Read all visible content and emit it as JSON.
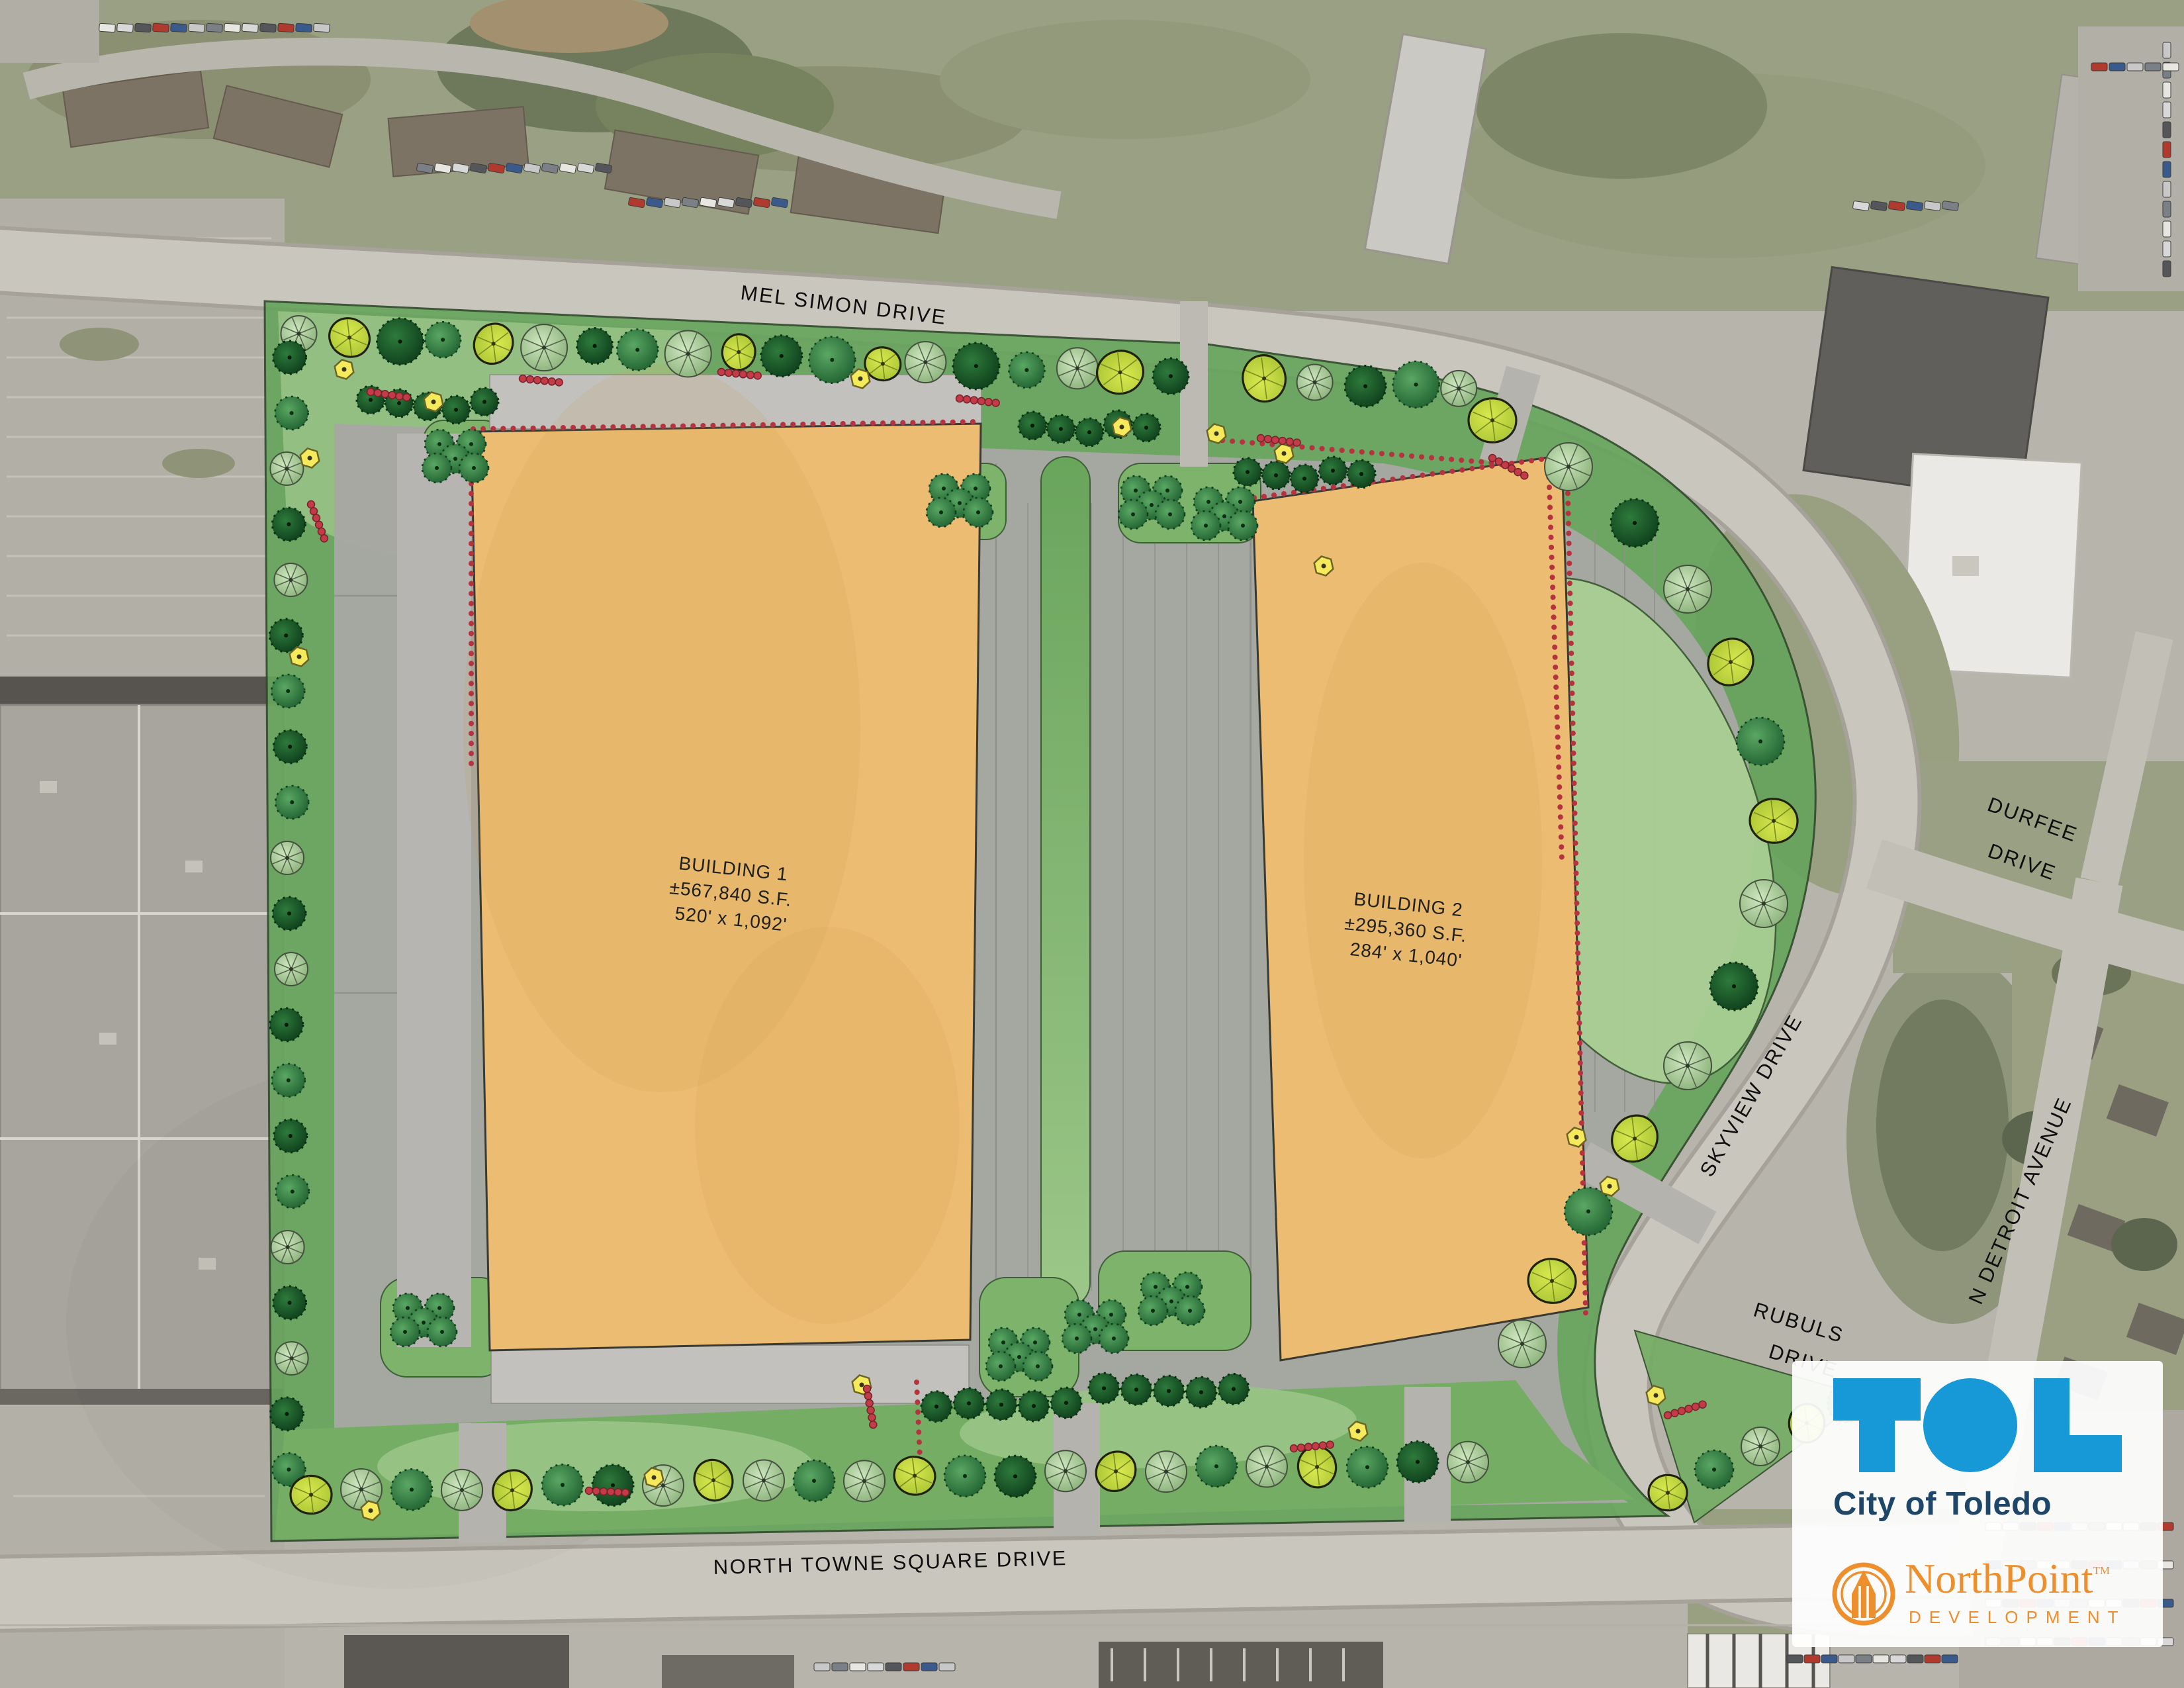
{
  "page": {
    "title": "North Towne Square redevelopment site plan aerial"
  },
  "site": {
    "streets": {
      "mel_simon": "MEL SIMON DRIVE",
      "north_towne": "NORTH TOWNE SQUARE DRIVE",
      "skyview": "SKYVIEW DRIVE",
      "durfee_line1": "DURFEE",
      "durfee_line2": "DRIVE",
      "n_detroit": "N DETROIT AVENUE",
      "rubuls_line1": "RUBULS",
      "rubuls_line2": "DRIVE"
    },
    "buildings": [
      {
        "name": "BUILDING 1",
        "area": "±567,840 S.F.",
        "dimensions": "520' x 1,092'"
      },
      {
        "name": "BUILDING 2",
        "area": "±295,360 S.F.",
        "dimensions": "284' x 1,040'"
      }
    ]
  },
  "branding": {
    "toledo": {
      "logo_text": "TOL",
      "name": "City of Toledo"
    },
    "northpoint": {
      "name": "NorthPoint",
      "trademark": "TM",
      "subtitle": "DEVELOPMENT"
    }
  },
  "palette": {
    "tol_blue": "#1699d6",
    "tol_navy": "#1d4668",
    "northpoint_orange": "#ee8f2e",
    "plan_green": "#66a45c",
    "plan_green_light": "#9ac487",
    "pavement": "#a8a7a3",
    "building_pad": "#ecbc72",
    "tree_dark": "#1c5b2d",
    "tree_medium": "#4a9757",
    "tree_light": "#b7d7a4",
    "tree_yellow_green": "#c6d944",
    "shrub_yellow": "#f5ea5c",
    "berry_red": "#c23b47"
  }
}
